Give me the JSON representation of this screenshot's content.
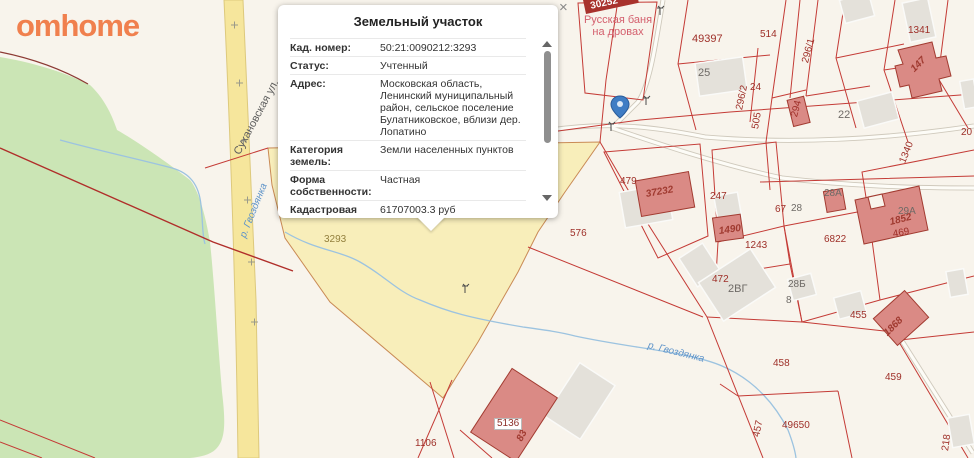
{
  "logo": {
    "text": "omhome"
  },
  "popup": {
    "title": "Земельный участок",
    "close_label": "×",
    "rows": [
      {
        "label": "Кад. номер:",
        "value": "50:21:0090212:3293"
      },
      {
        "label": "Статус:",
        "value": "Учтенный"
      },
      {
        "label": "Адрес:",
        "value": "Московская область, Ленинский муниципальный район, сельское поселение Булатниковское, вблизи дер. Лопатино"
      },
      {
        "label": "Категория земель:",
        "value": "Земли населенных пунктов"
      },
      {
        "label": "Форма собственности:",
        "value": "Частная"
      },
      {
        "label": "Кадастровая стоимость:",
        "value": "61707003.3 руб"
      },
      {
        "label": "Уточненная площадь:",
        "value": "7894 кв.м"
      }
    ]
  },
  "map": {
    "street_label": "Сухановская ул.",
    "river_label_west": "р. Гвоздянка",
    "river_label_south": "р. Гвоздянка",
    "poi_line1": "Русская баня",
    "poi_line2": "на дровах",
    "selected_banner": "30252",
    "parcel_labels": [
      "49397",
      "514",
      "296/1",
      "296/2",
      "294",
      "505",
      "24",
      "1341",
      "1340",
      "25",
      "22",
      "479",
      "247",
      "67",
      "28",
      "1243",
      "6822",
      "576",
      "472",
      "2ВГ",
      "28Б",
      "8",
      "455",
      "28А",
      "29А",
      "469",
      "458",
      "459",
      "457",
      "49650",
      "218",
      "1106",
      "3293",
      "3293",
      "20"
    ],
    "building_labels": [
      "37232",
      "1490",
      "1852",
      "147",
      "1868",
      "83",
      "5136"
    ],
    "colors": {
      "accent_red": "#c43b36",
      "selected_parcel_fill": "#f8eeba",
      "forest_green": "#cbe5b5",
      "road_yellow": "#f6e69c",
      "marker_blue": "#3f7dc4",
      "logo_orange": "#f0804e"
    }
  }
}
